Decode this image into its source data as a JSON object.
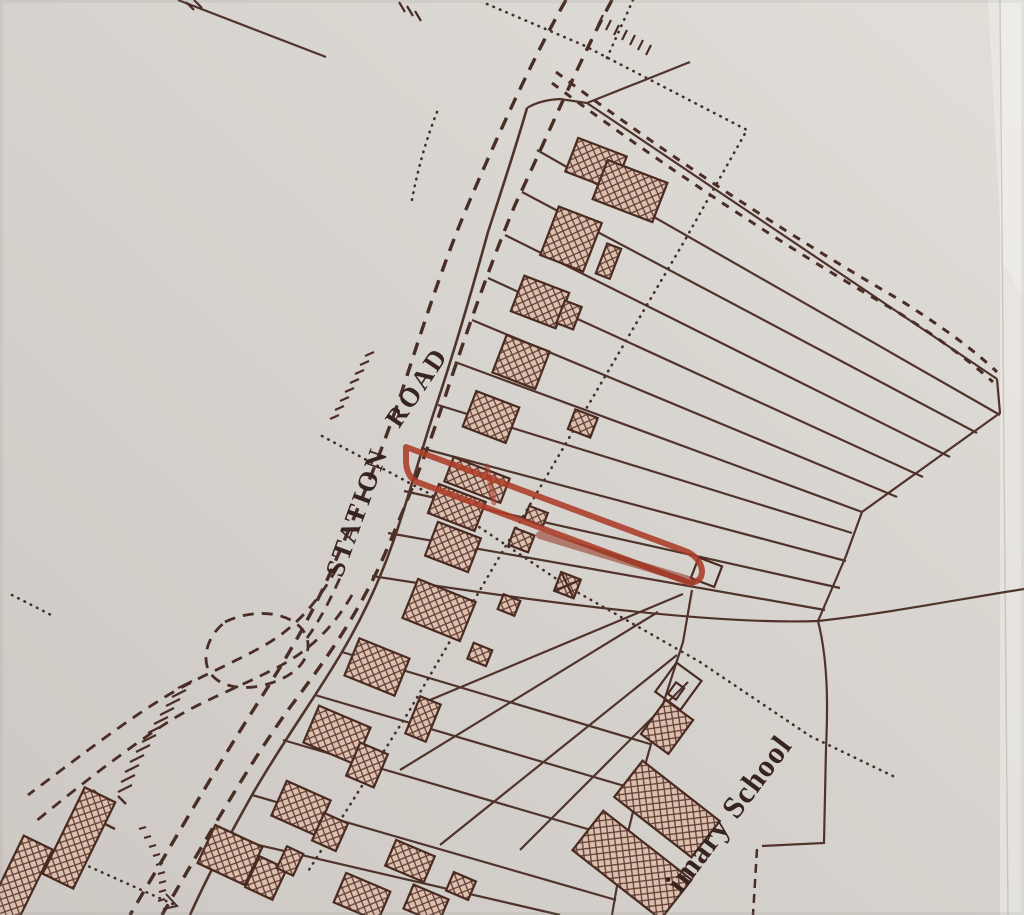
{
  "map": {
    "labels": {
      "road_words": [
        "STATION",
        "ROAD"
      ],
      "school": "imary School"
    },
    "colors": {
      "paper": "#d7d3ce",
      "ink": "#4a2e26",
      "plot_line": "#50342b",
      "hatch_tint": "#dcc0af",
      "hatch_line": "#5f3b31",
      "highlight": "#ac3c28",
      "highlight_dark": "#93301e",
      "text": "#372420"
    }
  }
}
